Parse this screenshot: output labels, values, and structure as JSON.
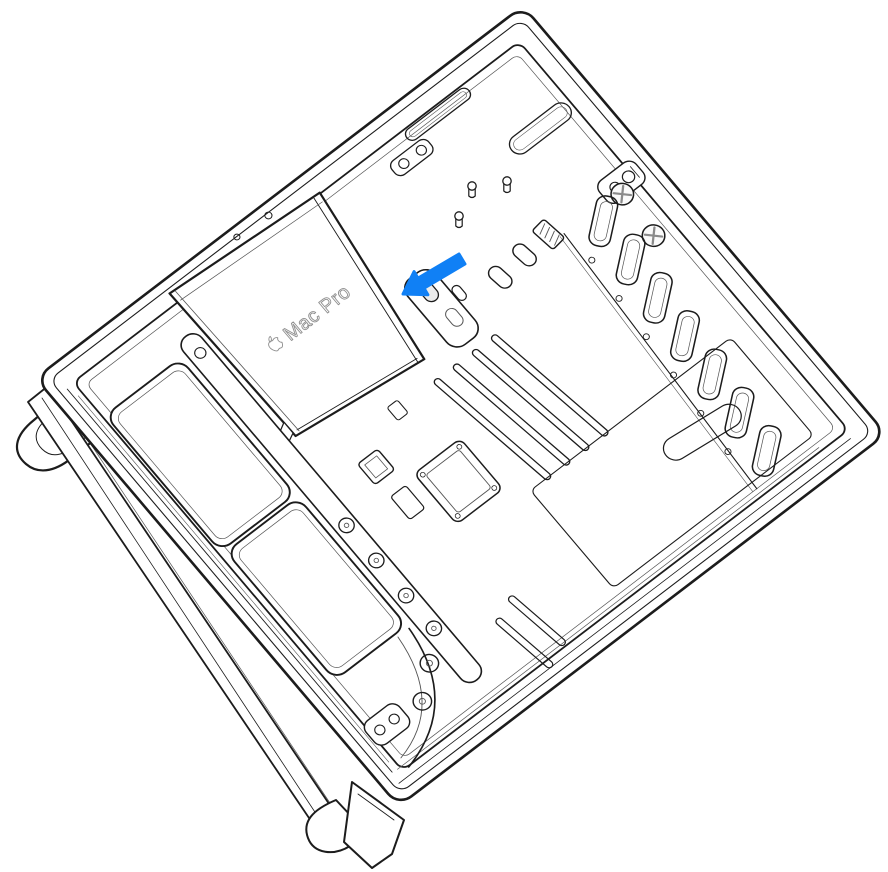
{
  "illustration": {
    "description": "Line drawing of a Mac Pro lying on its side with the side panel removed, showing internal components. A blue arrow points to the latch at the corner of the power supply cover.",
    "device_label": {
      "logo": "apple-logo",
      "text": "Mac Pro"
    },
    "arrow": {
      "color": "#1080f5",
      "direction": "down-left"
    },
    "colors": {
      "background": "#ffffff",
      "line": "#1c1c1c",
      "secondary_line": "#555555",
      "label_outline": "#8f8f8f",
      "screw_cross": "#8a8a8a",
      "recess_fill": "#ececec"
    }
  }
}
